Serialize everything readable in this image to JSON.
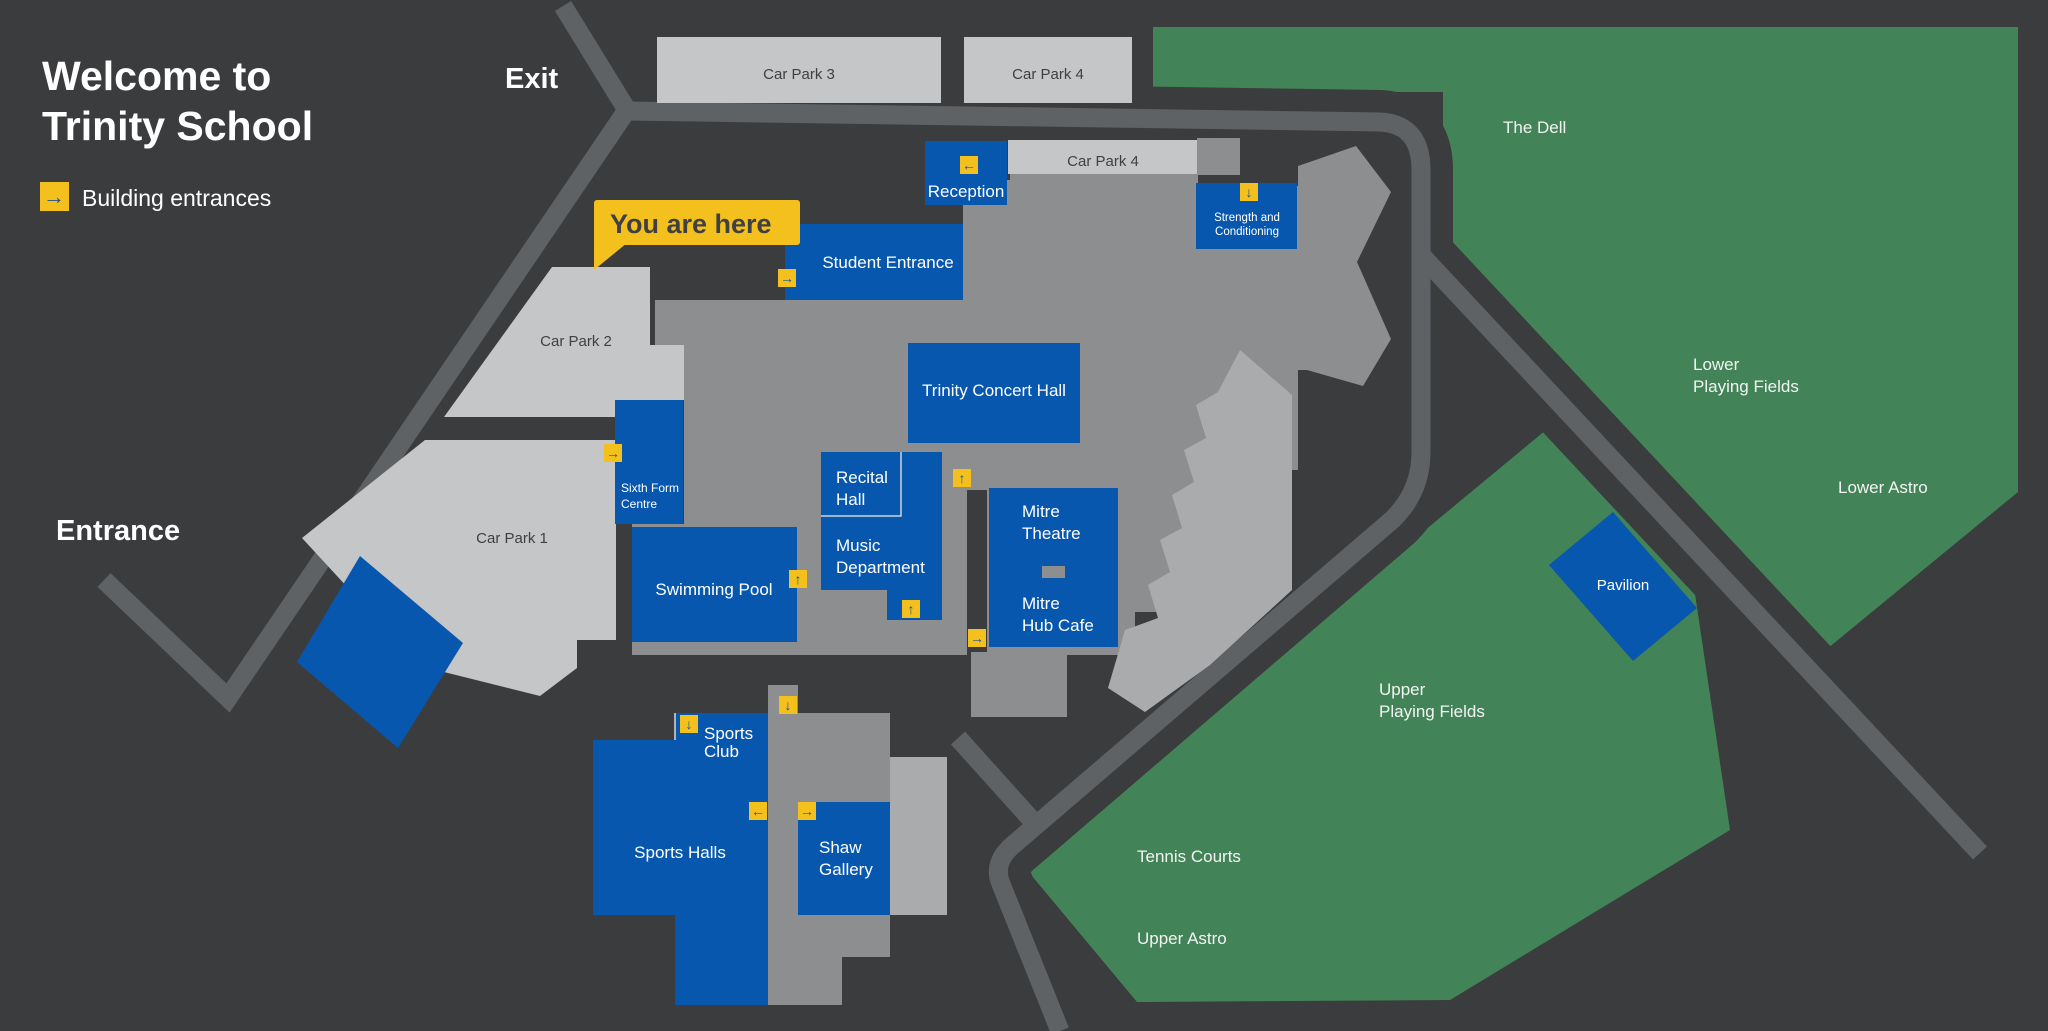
{
  "title": {
    "line1": "Welcome to",
    "line2": "Trinity School"
  },
  "legend": {
    "label": "Building entrances",
    "icon": "right-arrow-icon"
  },
  "road_labels": {
    "exit": "Exit",
    "entrance": "Entrance"
  },
  "you_are_here": {
    "label": "You are here"
  },
  "car_parks": {
    "cp1": "Car Park 1",
    "cp2": "Car Park 2",
    "cp3": "Car Park 3",
    "cp4_top": "Car Park 4",
    "cp4_inner": "Car Park 4"
  },
  "buildings": {
    "reception": "Reception",
    "strength_line1": "Strength and",
    "strength_line2": "Conditioning",
    "student_entrance": "Student Entrance",
    "concert_hall": "Trinity Concert Hall",
    "recital_line1": "Recital",
    "recital_line2": "Hall",
    "music_line1": "Music",
    "music_line2": "Department",
    "theatre_line1": "Mitre",
    "theatre_line2": "Theatre",
    "cafe_line1": "Mitre",
    "cafe_line2": "Hub Cafe",
    "sixth_line1": "Sixth Form",
    "sixth_line2": "Centre",
    "pool": "Swimming Pool",
    "sports_club_line1": "Sports",
    "sports_club_line2": "Club",
    "sports_halls": "Sports Halls",
    "shaw_line1": "Shaw",
    "shaw_line2": "Gallery",
    "pavilion": "Pavilion"
  },
  "grounds": {
    "dell": "The Dell",
    "lower_fields_line1": "Lower",
    "lower_fields_line2": "Playing Fields",
    "lower_astro": "Lower Astro",
    "upper_fields_line1": "Upper",
    "upper_fields_line2": "Playing Fields",
    "tennis": "Tennis Courts",
    "upper_astro": "Upper Astro"
  },
  "icons": {
    "up": "↑",
    "down": "↓",
    "left": "←",
    "right": "→"
  },
  "colors": {
    "background": "#3b3c3d",
    "road": "#5f6264",
    "building_blue": "#0857af",
    "building_gray": "#8c8e90",
    "building_light_gray": "#a9abad",
    "car_park_silver": "#c5c6c8",
    "field_green": "#438358",
    "entrance_yellow": "#f3c01d",
    "arrow_blue": "#1d5590"
  }
}
